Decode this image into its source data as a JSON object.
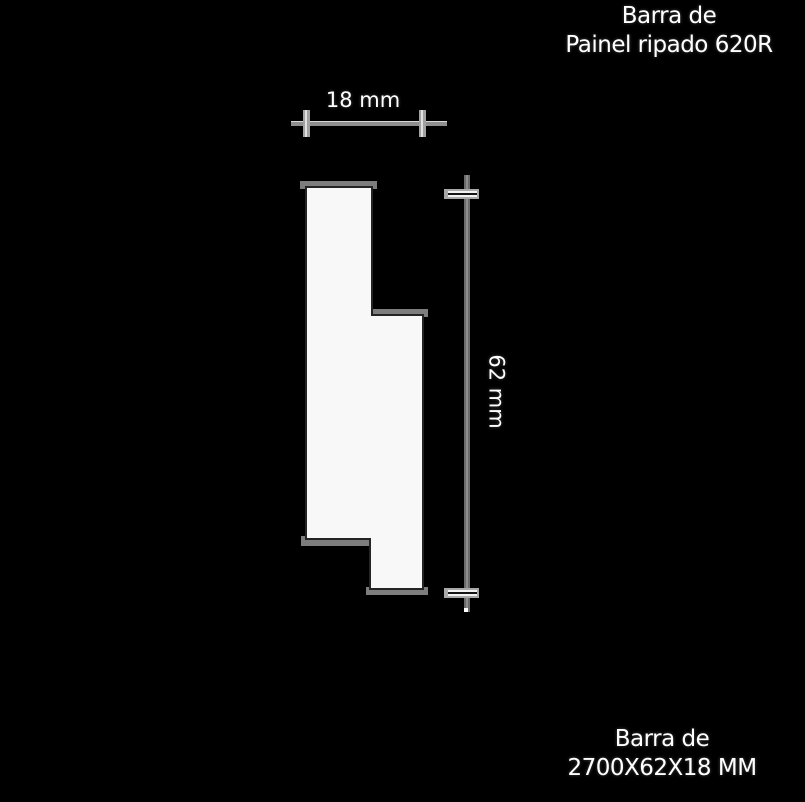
{
  "header": {
    "line1": "Barra de",
    "line2": "Painel ripado 620R"
  },
  "footer": {
    "line1": "Barra de",
    "line2": "2700X62X18 MM"
  },
  "dimensions": {
    "width_label": "18 mm",
    "height_label": "62 mm"
  },
  "colors": {
    "background": "#000000",
    "profile_fill": "#f8f8f8",
    "profile_outline": "#242424",
    "edge_band": "#7d7d7d",
    "dim_line": "#8f8f8f",
    "dim_line_vertical": "#6b6b6b",
    "dim_line_highlight": "#d8d8d8",
    "tick_fill": "#a2a2a2",
    "tick_highlight": "#e0e0e0",
    "cross_bar": "#a8a8a8",
    "cross_stripe": "#f2f2f2",
    "cross_center": "#141414",
    "text": "#ffffff"
  }
}
